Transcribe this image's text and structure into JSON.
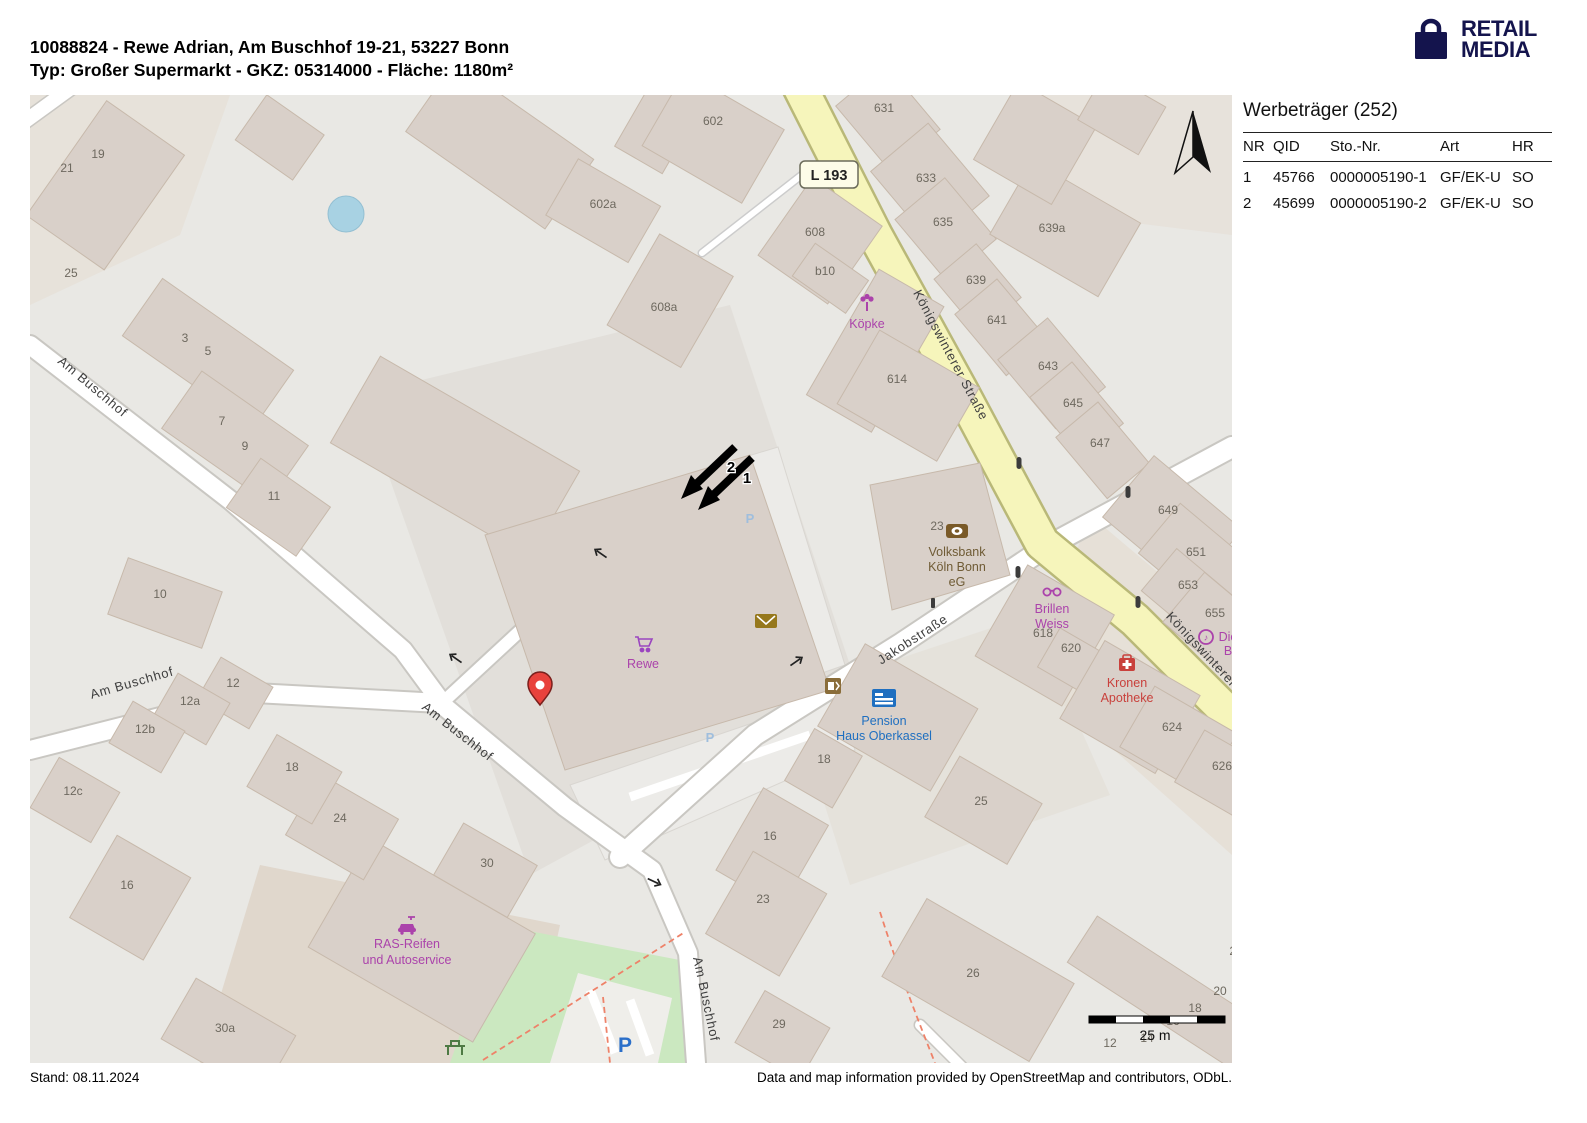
{
  "header": {
    "title_line1": "10088824 - Rewe Adrian, Am Buschhof 19-21, 53227 Bonn",
    "title_line2": "Typ: Großer Supermarkt - GKZ: 05314000 - Fläche: 1180m²",
    "logo": {
      "line1": "RETAIL",
      "line2": "MEDIA",
      "color": "#14144d"
    }
  },
  "panel": {
    "title": "Werbeträger (252)",
    "table": {
      "columns": [
        "NR",
        "QID",
        "Sto.-Nr.",
        "Art",
        "HR"
      ],
      "rows": [
        {
          "nr": "1",
          "qid": "45766",
          "sto_nr": "0000005190-1",
          "art": "GF/EK-U",
          "hr": "SO"
        },
        {
          "nr": "2",
          "qid": "45699",
          "sto_nr": "0000005190-2",
          "art": "GF/EK-U",
          "hr": "SO"
        }
      ]
    }
  },
  "footer": {
    "stand": "Stand: 08.11.2024",
    "attribution": "Data and map information provided by OpenStreetMap and contributors, ODbL."
  },
  "map": {
    "badge": "L 193",
    "scale": "25 m",
    "markers": {
      "m1": "1",
      "m2": "2"
    },
    "streets": {
      "am_buschhof": "Am Buschhof",
      "koenigswinterer": "Königswinterer Straße",
      "jakobstrasse": "Jakobstraße"
    },
    "pois": {
      "koepke": "Köpke",
      "rewe": "Rewe",
      "volksbank": [
        "Volksbank",
        "Köln Bonn",
        "eG"
      ],
      "brillen": [
        "Brillen",
        "Weiss"
      ],
      "kronen": [
        "Kronen",
        "Apotheke"
      ],
      "pension": [
        "Pension",
        "Haus Oberkassel"
      ],
      "ras": [
        "RAS-Reifen",
        "und Autoservice"
      ],
      "die_b": [
        "Die",
        "B"
      ],
      "parking": "P"
    },
    "house_numbers": [
      "21",
      "19",
      "25",
      "3",
      "5",
      "7",
      "9",
      "11",
      "10",
      "12",
      "12a",
      "12b",
      "12c",
      "18",
      "24",
      "16",
      "30",
      "30a",
      "602",
      "602a",
      "608",
      "b10",
      "608a",
      "614",
      "631",
      "633",
      "635",
      "639a",
      "639",
      "641",
      "643",
      "645",
      "647",
      "649",
      "651",
      "653",
      "655",
      "23",
      "618",
      "620",
      "624",
      "626",
      "18",
      "25",
      "16",
      "23",
      "26",
      "29",
      "22",
      "20",
      "18",
      "16",
      "14",
      "12"
    ]
  }
}
